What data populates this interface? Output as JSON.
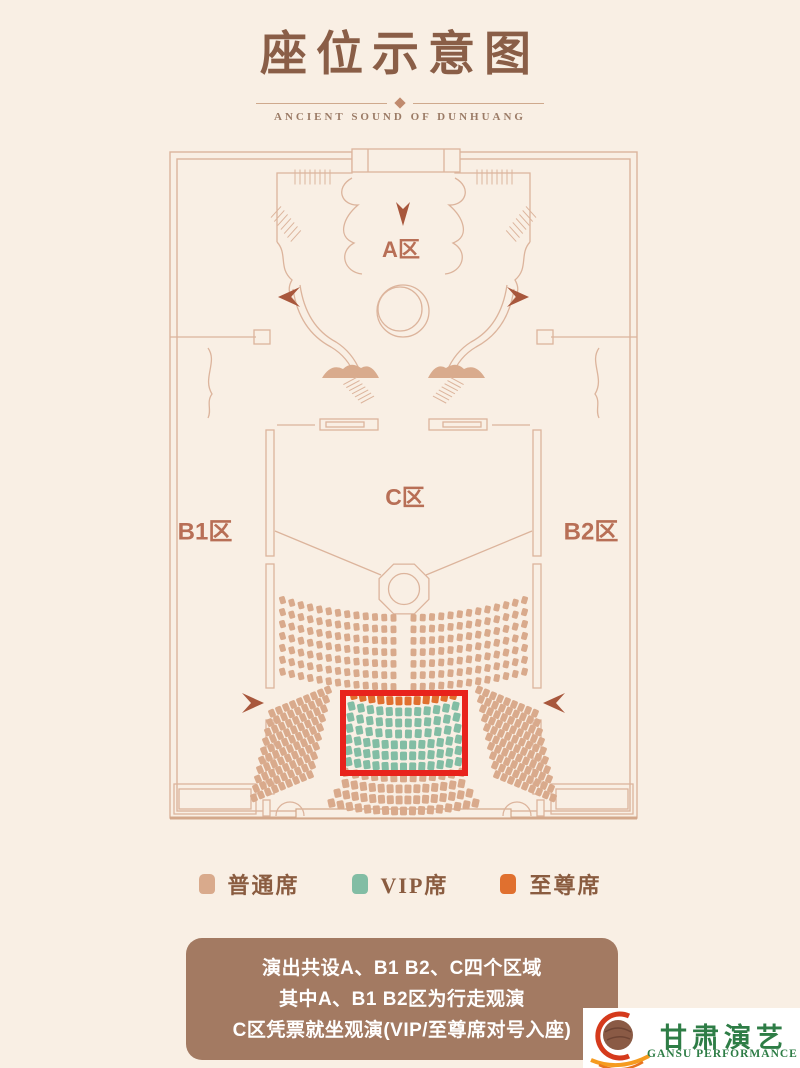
{
  "header": {
    "title": "座位示意图",
    "subtitle": "ANCIENT SOUND OF DUNHUANG"
  },
  "plan": {
    "zones": {
      "a": "A区",
      "b1": "B1区",
      "b2": "B2区",
      "c": "C区"
    },
    "line_color": "#dcb49c",
    "rock_fill": "#d9ab8d",
    "arrow_color": "#a8573c",
    "highlight_box_color": "#e8231c"
  },
  "seat_map": {
    "seat_colors": {
      "normal": "#d9aa8c",
      "vip": "#82bda4",
      "supreme": "#e0702f"
    },
    "sections": [
      {
        "id": "upper-left",
        "type": "normal",
        "rows": 7,
        "seats_per_row": 13
      },
      {
        "id": "upper-right",
        "type": "normal",
        "rows": 7,
        "seats_per_row": 13
      },
      {
        "id": "wing-left",
        "type": "normal",
        "rows": 10,
        "seats_per_row": 9
      },
      {
        "id": "wing-right",
        "type": "normal",
        "rows": 10,
        "seats_per_row": 9
      },
      {
        "id": "center",
        "type": "rows",
        "rows": 11,
        "seats_per_row": [
          12,
          12,
          12,
          12,
          13,
          13,
          13,
          13,
          14,
          16,
          17
        ],
        "row_types": [
          "supreme",
          "vip",
          "vip",
          "vip",
          "vip",
          "vip",
          "vip",
          "normal",
          "normal",
          "normal",
          "normal"
        ]
      }
    ]
  },
  "legend": {
    "items": [
      {
        "label": "普通席",
        "type": "normal",
        "color": "#d9aa8c"
      },
      {
        "label": "VIP席",
        "type": "vip",
        "color": "#82bda4"
      },
      {
        "label": "至尊席",
        "type": "supreme",
        "color": "#e0702f"
      }
    ]
  },
  "notes": {
    "bg": "#a37a62",
    "lines": [
      "演出共设A、B1 B2、C四个区域",
      "其中A、B1 B2区为行走观演",
      "C区凭票就坐观演(VIP/至尊席对号入座)"
    ]
  },
  "logo": {
    "name_cn": "甘肃演艺",
    "name_en": "GANSU PERFORMANCE",
    "green": "#2e7d46"
  }
}
